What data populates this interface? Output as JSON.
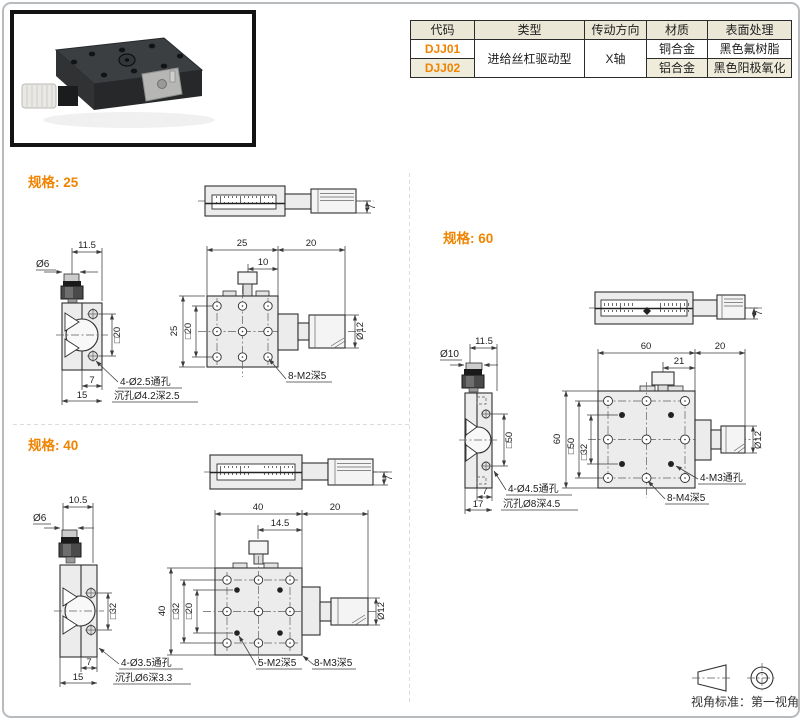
{
  "table": {
    "headers": [
      "代码",
      "类型",
      "传动方向",
      "材质",
      "表面处理"
    ],
    "rows": [
      {
        "code": "DJJ01",
        "type": "进给丝杠驱动型",
        "direction": "X轴",
        "material": "铜合金",
        "finish": "黑色氟树脂"
      },
      {
        "code": "DJJ02",
        "material": "铝合金",
        "finish": "黑色阳极氧化"
      }
    ],
    "accent_color": "#f08300",
    "header_bg": "#ebe7d6"
  },
  "sections": {
    "spec25": {
      "title": "规格: 25",
      "top_view": {
        "height": "7"
      },
      "side_view": {
        "w1": "11.5",
        "knob": "Ø6",
        "sq": "□20",
        "d1": "7",
        "d2": "15",
        "callout1": "4-Ø2.5通孔",
        "callout2": "沉孔Ø4.2深2.5"
      },
      "plan_view": {
        "w": "25",
        "knob_len": "20",
        "inner": "10",
        "h": "25",
        "sq": "□20",
        "knob_dia": "Ø12",
        "callout1": "8-M2深5"
      }
    },
    "spec40": {
      "title": "规格: 40",
      "top_view": {
        "height": "7"
      },
      "side_view": {
        "w1": "10.5",
        "knob": "Ø6",
        "sq": "□32",
        "d1": "7",
        "d2": "15",
        "callout1": "4-Ø3.5通孔",
        "callout2": "沉孔Ø6深3.3"
      },
      "plan_view": {
        "w": "40",
        "knob_len": "20",
        "inner": "14.5",
        "h": "40",
        "sq1": "□32",
        "sq2": "□20",
        "knob_dia": "Ø12",
        "callout1": "5-M2深5",
        "callout2": "8-M3深5"
      }
    },
    "spec60": {
      "title": "规格: 60",
      "top_view": {
        "height": "7"
      },
      "side_view": {
        "w1": "11.5",
        "knob": "Ø10",
        "sq": "□50",
        "d1": "7",
        "d2": "17",
        "callout1": "4-Ø4.5通孔",
        "callout2": "沉孔Ø8深4.5"
      },
      "plan_view": {
        "w": "60",
        "knob_len": "20",
        "inner": "21",
        "h": "60",
        "sq1": "□50",
        "sq2": "□32",
        "knob_dia": "Ø12",
        "callout1": "4-M3通孔",
        "callout2": "8-M4深5"
      }
    }
  },
  "footer": {
    "view_standard": "视角标准：第一视角"
  }
}
